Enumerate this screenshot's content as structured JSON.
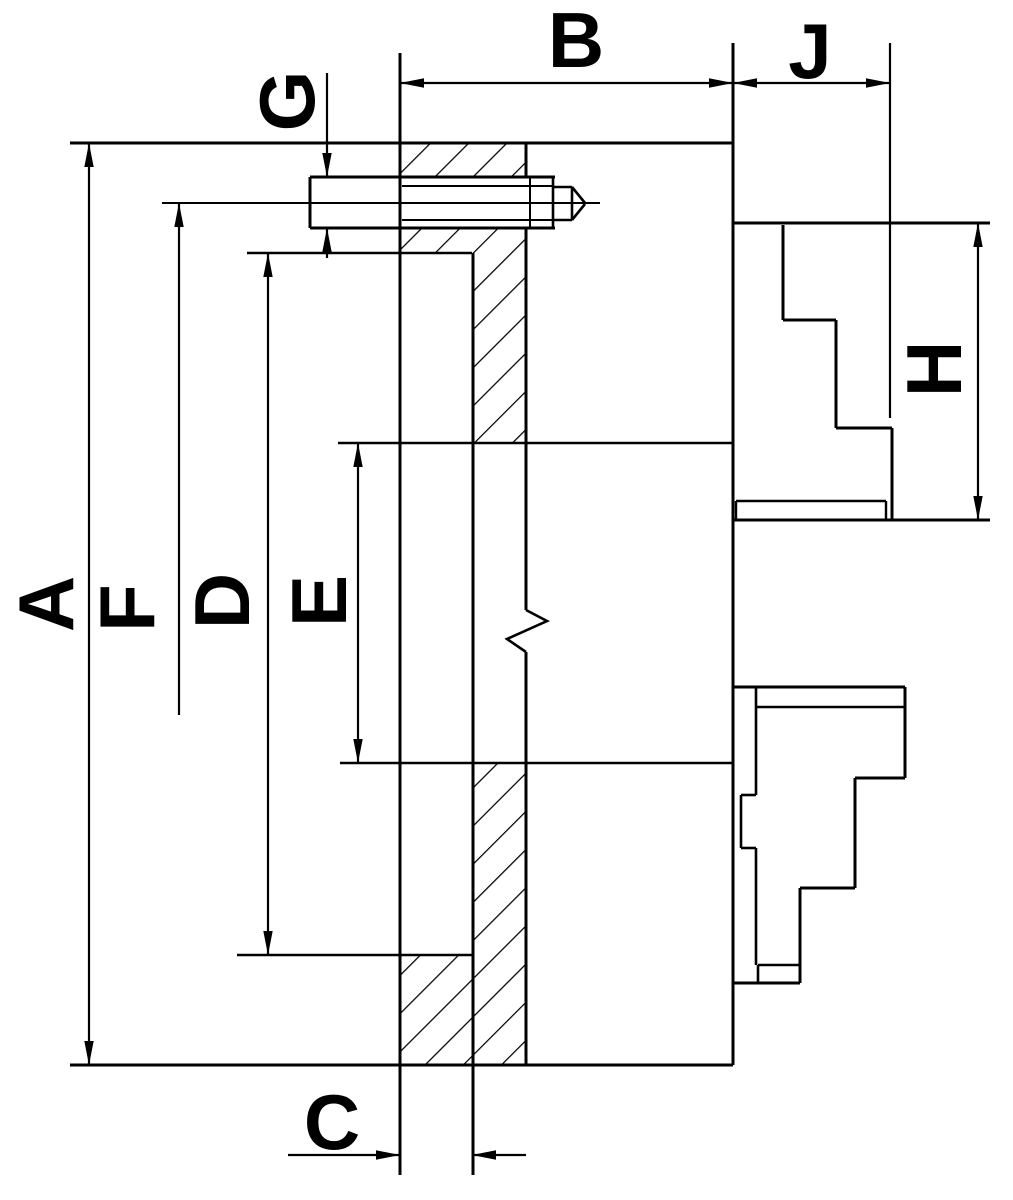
{
  "title": "Lathe chuck cross-section dimensional drawing",
  "colors": {
    "ink": "#000000",
    "background": "#ffffff"
  },
  "labels": [
    {
      "id": "A",
      "text": "A",
      "x": 46,
      "y": 604,
      "rotated": true
    },
    {
      "id": "F",
      "text": "F",
      "x": 127,
      "y": 608,
      "rotated": true
    },
    {
      "id": "D",
      "text": "D",
      "x": 222,
      "y": 601,
      "rotated": true
    },
    {
      "id": "E",
      "text": "E",
      "x": 319,
      "y": 601,
      "rotated": true
    },
    {
      "id": "G",
      "text": "G",
      "x": 287,
      "y": 101,
      "rotated": true
    },
    {
      "id": "H",
      "text": "H",
      "x": 934,
      "y": 369,
      "rotated": true
    },
    {
      "id": "B",
      "text": "B",
      "x": 576,
      "y": 40,
      "rotated": false
    },
    {
      "id": "J",
      "text": "J",
      "x": 810,
      "y": 51,
      "rotated": false
    },
    {
      "id": "C",
      "text": "C",
      "x": 332,
      "y": 1122,
      "rotated": false
    }
  ],
  "dimensions": [
    {
      "letter": "A",
      "meaning": "outside diameter",
      "axis": "vertical",
      "line_x": 89,
      "from_y": 143,
      "to_y": 1065
    },
    {
      "letter": "F",
      "meaning": "bolt circle diameter",
      "axis": "vertical",
      "line_x": 179,
      "from_y": 203,
      "to_y": 715
    },
    {
      "letter": "D",
      "meaning": "recess diameter",
      "axis": "vertical",
      "line_x": 268,
      "from_y": 253,
      "to_y": 955
    },
    {
      "letter": "E",
      "meaning": "bore diameter",
      "axis": "vertical",
      "line_x": 358,
      "from_y": 443,
      "to_y": 763
    },
    {
      "letter": "G",
      "meaning": "mounting hole diameter",
      "axis": "vertical",
      "line_x": 327,
      "from_y": 178,
      "to_y": 228
    },
    {
      "letter": "B",
      "meaning": "body depth",
      "axis": "horizontal",
      "line_y": 83,
      "from_x": 400,
      "to_x": 733
    },
    {
      "letter": "J",
      "meaning": "jaw projection",
      "axis": "horizontal",
      "line_y": 83,
      "from_x": 733,
      "to_x": 890
    },
    {
      "letter": "H",
      "meaning": "jaw height",
      "axis": "vertical",
      "line_x": 978,
      "from_y": 223,
      "to_y": 520
    },
    {
      "letter": "C",
      "meaning": "hub width",
      "axis": "horizontal",
      "line_y": 1155,
      "from_x": 400,
      "to_x": 472
    }
  ],
  "drawing": {
    "segments": [
      [
        70,
        143,
        733,
        143,
        3
      ],
      [
        70,
        1065,
        733,
        1065,
        3
      ],
      [
        400,
        53,
        400,
        1175,
        3
      ],
      [
        733,
        43,
        733,
        1065,
        3
      ],
      [
        473,
        253,
        473,
        1175,
        3
      ],
      [
        526,
        143,
        526,
        177,
        3
      ],
      [
        526,
        228,
        526,
        610,
        3
      ],
      [
        526,
        652,
        526,
        1065,
        3
      ],
      [
        310,
        177,
        555,
        177,
        3
      ],
      [
        310,
        228,
        555,
        228,
        3
      ],
      [
        310,
        177,
        310,
        228,
        3
      ],
      [
        402,
        186,
        553,
        186,
        2
      ],
      [
        402,
        220,
        553,
        220,
        2
      ],
      [
        530,
        177,
        530,
        228,
        2
      ],
      [
        553,
        177,
        553,
        228,
        2.6
      ],
      [
        553,
        187,
        572,
        187,
        2.6
      ],
      [
        553,
        220,
        572,
        220,
        2.6
      ],
      [
        572,
        187,
        572,
        220,
        2.6
      ],
      [
        572,
        187,
        585,
        203,
        2.6
      ],
      [
        572,
        220,
        585,
        204,
        2.6
      ],
      [
        162,
        203,
        600,
        203,
        2
      ],
      [
        247,
        253,
        472,
        253,
        2.4
      ],
      [
        338,
        443,
        733,
        443,
        2.6
      ],
      [
        340,
        763,
        733,
        763,
        2.6
      ],
      [
        237,
        955,
        473,
        955,
        2.6
      ],
      [
        89,
        143,
        89,
        1065,
        2.2
      ],
      [
        179,
        203,
        179,
        715,
        2.2
      ],
      [
        268,
        253,
        268,
        955,
        2.2
      ],
      [
        358,
        443,
        358,
        763,
        2.2
      ],
      [
        327,
        73,
        327,
        177,
        2.2
      ],
      [
        327,
        228,
        327,
        258,
        2.2
      ],
      [
        400,
        83,
        733,
        83,
        2.2
      ],
      [
        733,
        83,
        890,
        83,
        2.2
      ],
      [
        978,
        223,
        978,
        520,
        2.2
      ],
      [
        288,
        1155,
        400,
        1155,
        2.2
      ],
      [
        472,
        1155,
        526,
        1155,
        2.2
      ],
      [
        890,
        43,
        890,
        418,
        2.2
      ],
      [
        734,
        223,
        990,
        223,
        3
      ],
      [
        734,
        520,
        990,
        520,
        3
      ],
      [
        783,
        225,
        783,
        320,
        3
      ],
      [
        783,
        320,
        836,
        320,
        3
      ],
      [
        836,
        320,
        836,
        428,
        3
      ],
      [
        836,
        428,
        892,
        428,
        3
      ],
      [
        892,
        428,
        892,
        520,
        3
      ],
      [
        736,
        501,
        886,
        501,
        2.4
      ],
      [
        886,
        501,
        886,
        520,
        2.4
      ],
      [
        736,
        501,
        736,
        520,
        2.4
      ],
      [
        734,
        687,
        905,
        687,
        3
      ],
      [
        756,
        707,
        905,
        707,
        2.6
      ],
      [
        905,
        687,
        905,
        778,
        3
      ],
      [
        855,
        778,
        905,
        778,
        3
      ],
      [
        855,
        778,
        855,
        888,
        3
      ],
      [
        800,
        888,
        855,
        888,
        3
      ],
      [
        800,
        888,
        800,
        983,
        3
      ],
      [
        758,
        965,
        800,
        965,
        2.6
      ],
      [
        734,
        983,
        800,
        983,
        3
      ],
      [
        758,
        965,
        758,
        983,
        2.6
      ],
      [
        756,
        687,
        756,
        795,
        2.6
      ],
      [
        756,
        848,
        756,
        965,
        2.6
      ],
      [
        741,
        795,
        756,
        795,
        2.6
      ],
      [
        741,
        795,
        741,
        848,
        2.6
      ],
      [
        741,
        848,
        756,
        848,
        2.6
      ]
    ],
    "polylines": [
      {
        "points": "526,610 547,621 507,639 526,652",
        "w": 2.6
      }
    ],
    "arrows": [
      {
        "x": 89,
        "y": 143,
        "dir": "up"
      },
      {
        "x": 89,
        "y": 1065,
        "dir": "down"
      },
      {
        "x": 179,
        "y": 203,
        "dir": "up"
      },
      {
        "x": 268,
        "y": 253,
        "dir": "up"
      },
      {
        "x": 268,
        "y": 955,
        "dir": "down"
      },
      {
        "x": 358,
        "y": 443,
        "dir": "up"
      },
      {
        "x": 358,
        "y": 763,
        "dir": "down"
      },
      {
        "x": 327,
        "y": 177,
        "dir": "down"
      },
      {
        "x": 327,
        "y": 228,
        "dir": "up"
      },
      {
        "x": 400,
        "y": 83,
        "dir": "left"
      },
      {
        "x": 733,
        "y": 83,
        "dir": "right"
      },
      {
        "x": 733,
        "y": 83,
        "dir": "left"
      },
      {
        "x": 890,
        "y": 83,
        "dir": "right"
      },
      {
        "x": 978,
        "y": 223,
        "dir": "up"
      },
      {
        "x": 978,
        "y": 520,
        "dir": "down"
      },
      {
        "x": 400,
        "y": 1155,
        "dir": "right"
      },
      {
        "x": 472,
        "y": 1155,
        "dir": "left"
      }
    ],
    "hatch_regions": [
      {
        "x": 400,
        "y": 143,
        "w": 125,
        "h": 34
      },
      {
        "x": 400,
        "y": 228,
        "w": 125,
        "h": 25
      },
      {
        "x": 472,
        "y": 253,
        "w": 53,
        "h": 190
      },
      {
        "x": 473,
        "y": 763,
        "w": 53,
        "h": 302
      },
      {
        "x": 400,
        "y": 954,
        "w": 73,
        "h": 111
      }
    ],
    "arrow_length": 24,
    "arrow_half_width": 4.7,
    "label_font_size": 78
  }
}
